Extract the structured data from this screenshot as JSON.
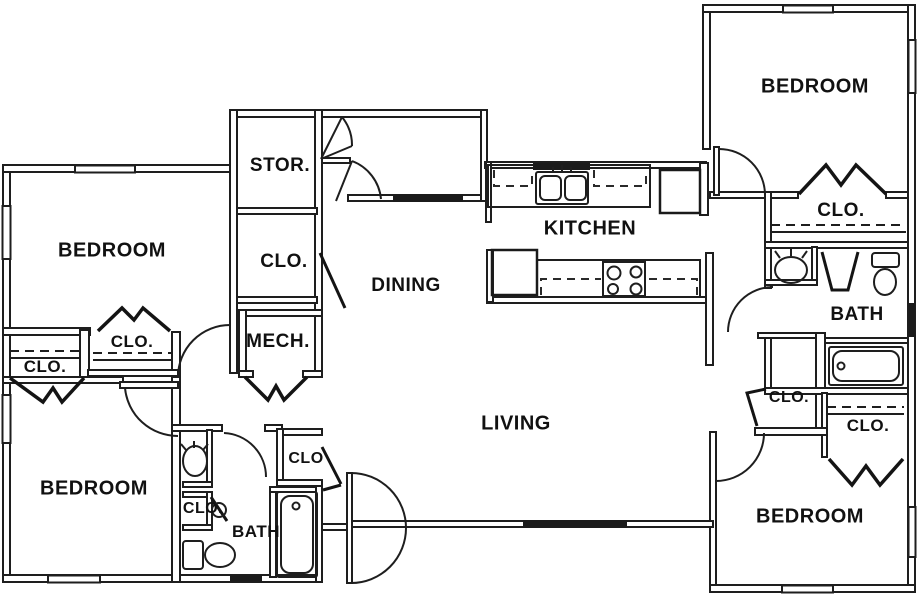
{
  "image": {
    "background_color": "#ffffff",
    "line_color": "#1e1e1e"
  },
  "floor_plan": {
    "labels": [
      {
        "id": "bedroom-top-left",
        "text": "BEDROOM"
      },
      {
        "id": "clo-left-outer",
        "text": "CLO."
      },
      {
        "id": "clo-left-inner",
        "text": "CLO."
      },
      {
        "id": "bedroom-bottom-left",
        "text": "BEDROOM"
      },
      {
        "id": "clo-linen-left-bath",
        "text": "CLO."
      },
      {
        "id": "bath-bottom-left",
        "text": "BATH"
      },
      {
        "id": "clo-entry",
        "text": "CLO"
      },
      {
        "id": "storage",
        "text": "STOR."
      },
      {
        "id": "clo-column",
        "text": "CLO."
      },
      {
        "id": "mechanical",
        "text": "MECH."
      },
      {
        "id": "dining",
        "text": "DINING"
      },
      {
        "id": "kitchen",
        "text": "KITCHEN"
      },
      {
        "id": "living",
        "text": "LIVING"
      },
      {
        "id": "bedroom-top-right",
        "text": "BEDROOM"
      },
      {
        "id": "clo-top-right",
        "text": "CLO."
      },
      {
        "id": "bath-right",
        "text": "BATH"
      },
      {
        "id": "clo-right-hall",
        "text": "CLO."
      },
      {
        "id": "clo-right-shelf",
        "text": "CLO."
      },
      {
        "id": "bedroom-bottom-right",
        "text": "BEDROOM"
      }
    ],
    "fixtures": [
      "double-kitchen-sink",
      "range-4-burner",
      "refrigerator",
      "pantry-cabinet",
      "bathtub-right",
      "bathtub-left",
      "toilet-right",
      "toilet-left",
      "vanity-sink-right",
      "vanity-sink-left"
    ]
  }
}
